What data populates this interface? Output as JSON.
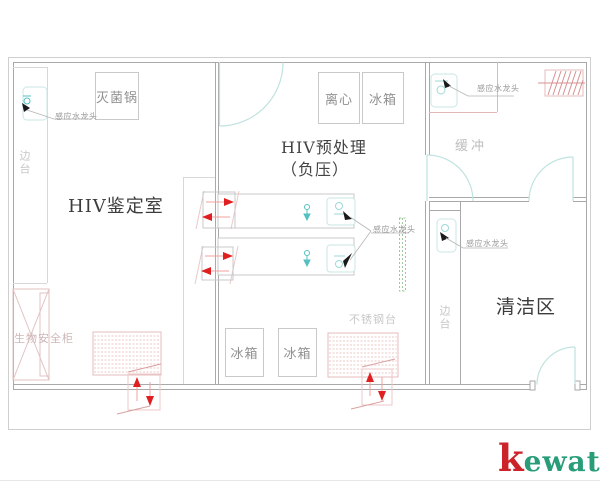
{
  "rooms": {
    "hiv_identification": "HIV鉴定室",
    "hiv_pretreatment_line1": "HIV预处理",
    "hiv_pretreatment_line2": "（负压）",
    "buffer": "缓冲",
    "clean_area": "清洁区"
  },
  "equipment": {
    "sterilizer": "灭菌锅",
    "centrifuge": "离心",
    "fridge": "冰箱",
    "stainless_steel_bench": "不锈钢台",
    "biosafety_cabinet": "生物安全柜",
    "side_bench": "边台",
    "sensor_faucet": "感应水龙头"
  },
  "brand": {
    "initial": "k",
    "rest": "ewatt"
  },
  "icons": {
    "sensor-faucet-sink-icon": "cyan rounded square with faucet circle",
    "pointer-arrow-icon": "small black triangle pointer",
    "airflow-arrow-icon": "red triangle with tail",
    "door-swing-icon": "light cyan quarter arc with leaf",
    "exhaust-grille-icon": "pink hatched rectangle",
    "transfer-window-icon": "wall box with opposing red arrows",
    "biosafety-cross-icon": "rectangle with X cross",
    "eyewash-icon": "small cyan stem with down arrow"
  },
  "colors": {
    "wall_gray": "#a9a9a9",
    "light_gray": "#d8d8d8",
    "pink_line": "#e4bcbc",
    "accent_cyan": "#9fd8d8",
    "door_cyan": "#bfe3e0",
    "arrow_red": "#e02020",
    "green_hatch": "#7ab87a",
    "room_text": "#3c3c3c",
    "label_gray": "#909090",
    "brand_red": "#cc2229",
    "brand_green": "#289d78"
  }
}
